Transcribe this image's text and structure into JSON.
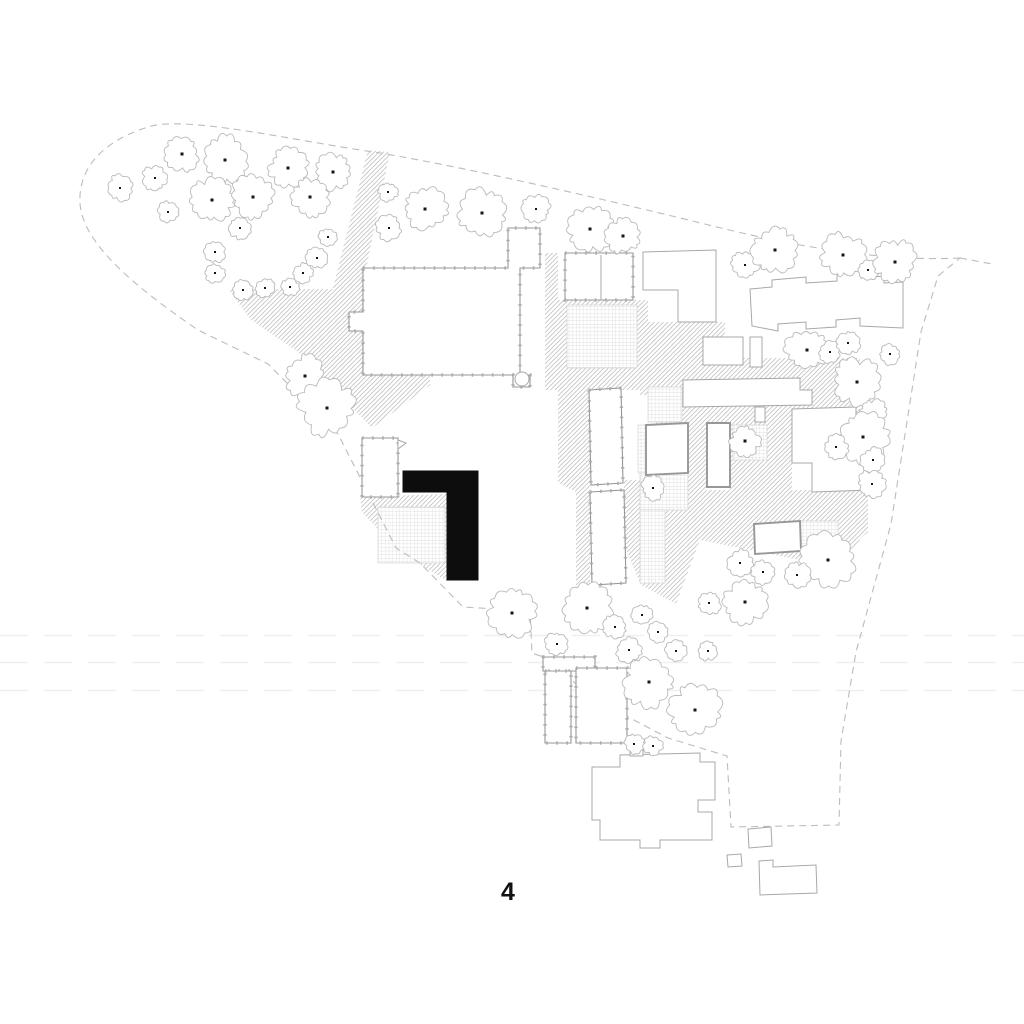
{
  "page": {
    "background": "#ffffff",
    "label": {
      "text": "4",
      "x": 508,
      "y": 878
    }
  },
  "colors": {
    "background": "#ffffff",
    "line_light": "#a8a8a8",
    "line_medium": "#979797",
    "tick_line": "#a6a6a6",
    "tree_line": "#b9b9b9",
    "tree_dot": "#151515",
    "hatch_line": "#c4c4c4",
    "grid_line": "#d3d3d3",
    "boundary_line": "#bcbcbc",
    "faint_line": "#efefef",
    "highlight": "#0d0d0d",
    "label_color": "#111111"
  },
  "plan": {
    "boundary": {
      "path": "M 960,258 C 880,262 790,245 717,227 C 620,203 470,168 380,153 C 290,140 185,115 148,127 C 103,141 78,168 80,203 C 82,243 135,287 198,330 L 268,364 L 338,434 L 396,548 L 420,563 L 463,607 L 530,611 L 532,653 L 543,657 L 596,700 L 668,738 L 727,756 L 731,827 L 839,825 L 841,741 L 856,652 L 891,524 L 921,332 L 938,276 Z",
      "tip_path": "M 960,258 L 992,264",
      "dash": "7 5"
    },
    "faint_line_ys": [
      635.5,
      662.5,
      690.5
    ],
    "hatch_areas": [
      {
        "id": "path-north",
        "points": "368,150 390,152 360,298 332,292"
      },
      {
        "id": "west-plaza",
        "points": "228,289 363,289 363,373 430,373 430,385 372,428 298,352 251,320"
      },
      {
        "id": "court-band-black-building",
        "points": "360,497 447,494 447,581 437,575 396,549 362,512"
      },
      {
        "id": "corridor",
        "points": "545,253 558,253 558,390 545,390"
      },
      {
        "id": "east-court-block",
        "points": "558,300 648,300 648,390 558,390"
      },
      {
        "id": "under-east-wing",
        "points": "640,322 725,322 725,395 640,395"
      },
      {
        "id": "north-band-right",
        "points": "655,358 860,358 860,425 655,425"
      },
      {
        "id": "west-of-bars",
        "points": "558,388 590,388 590,587 576,587 576,492 558,483"
      },
      {
        "id": "bars-gap-tail",
        "points": "624,480 700,480 700,540 676,604 641,585 624,545"
      },
      {
        "id": "mid-gap-1",
        "points": "688,420 707,420 707,500 688,500"
      },
      {
        "id": "mid-gap-2",
        "points": "730,408 792,408 792,500 730,500"
      },
      {
        "id": "south-right-field",
        "points": "700,490 868,490 868,532 840,556 800,560 700,540"
      },
      {
        "id": "east-house-patch",
        "points": "798,518 845,515 860,540 840,565 798,556"
      }
    ],
    "grid_areas": [
      {
        "id": "east-courtyard",
        "x": 567,
        "y": 305,
        "w": 70,
        "h": 63
      },
      {
        "id": "black-building-courtyard",
        "x": 378,
        "y": 507,
        "w": 67,
        "h": 56
      },
      {
        "id": "mid-court-tree",
        "x": 733,
        "y": 425,
        "w": 34,
        "h": 35
      },
      {
        "id": "southeast-court",
        "x": 800,
        "y": 521,
        "w": 38,
        "h": 35
      },
      {
        "id": "cloister-west-strip",
        "x": 638,
        "y": 425,
        "w": 10,
        "h": 48
      },
      {
        "id": "cloister-north",
        "x": 648,
        "y": 387,
        "w": 34,
        "h": 35
      },
      {
        "id": "cloister-south",
        "x": 640,
        "y": 473,
        "w": 48,
        "h": 37
      },
      {
        "id": "cloister-south-strip",
        "x": 640,
        "y": 510,
        "w": 25,
        "h": 73
      }
    ],
    "buildings": [
      {
        "id": "main-hall",
        "style": "ticked",
        "points": "363,268 508,268 508,228 540,228 540,268 520,268 520,375 530,375 530,387 513,387 513,375 363,375 363,331 349,331 349,312 363,312"
      },
      {
        "id": "east-rooms",
        "style": "ticked",
        "points": "565,253 633,253 633,300 565,300"
      },
      {
        "id": "east-wing-l",
        "style": "light",
        "points": "643,252 716,250 716,322 678,322 678,290 643,290"
      },
      {
        "id": "small-north-a",
        "style": "light",
        "points": "703,337 743,337 743,365 703,365"
      },
      {
        "id": "small-north-b",
        "style": "light",
        "points": "750,337 762,337 762,367 750,367"
      },
      {
        "id": "terraced-row-east",
        "style": "light",
        "points": "750,289 772,287 772,280 806,277 806,283 837,281 837,273 861,271 861,278 884,276 884,283 903,282 903,328 860,326 860,318 836,320 836,327 806,329 806,322 778,324 778,331 752,326"
      },
      {
        "id": "long-bar-central",
        "style": "light",
        "points": "683,380 800,378 800,390 812,390 812,405 683,407"
      },
      {
        "id": "long-bar-stub",
        "style": "light",
        "points": "755,407 765,407 765,422 755,422"
      },
      {
        "id": "cloister-house",
        "style": "medium",
        "points": "646,425 688,423 688,473 646,475"
      },
      {
        "id": "narrow-house",
        "style": "medium",
        "points": "707,423 730,423 730,487 707,487"
      },
      {
        "id": "east-l-house",
        "style": "light",
        "points": "792,409 856,407 856,427 872,427 872,490 812,492 812,463 792,463"
      },
      {
        "id": "small-east-house",
        "style": "medium",
        "points": "754,524 800,521 801,551 755,554"
      },
      {
        "id": "west-bar-upper",
        "style": "ticked",
        "points": "589,390 621,388 623,483 591,485"
      },
      {
        "id": "west-bar-lower",
        "style": "ticked",
        "points": "590,492 624,490 626,583 592,585"
      },
      {
        "id": "northwest-small-house",
        "style": "ticked",
        "points": "362,438 398,438 398,497 362,497"
      },
      {
        "id": "northwest-pennant",
        "style": "light",
        "points": "398,440 406,443 398,449"
      },
      {
        "id": "row-houses-header",
        "style": "ticked",
        "points": "543,657 595,657 595,671 543,671"
      },
      {
        "id": "row-house-left",
        "style": "ticked",
        "points": "545,671 571,671 571,743 545,743"
      },
      {
        "id": "row-house-right",
        "style": "ticked",
        "points": "576,668 627,668 627,743 576,743"
      },
      {
        "id": "south-church",
        "style": "light",
        "points": "592,767 620,767 620,755 700,753 700,762 715,762 715,800 698,800 698,812 712,812 712,840 660,840 660,848 640,848 640,840 600,840 600,820 592,820"
      },
      {
        "id": "south-church-stub",
        "style": "light",
        "points": "630,743 643,743 643,756 630,756"
      },
      {
        "id": "outbuilding-a",
        "style": "light",
        "points": "748,829 771,827 772,846 749,848"
      },
      {
        "id": "outbuilding-b",
        "style": "light",
        "points": "727,855 741,854 742,866 728,867"
      },
      {
        "id": "outbuilding-c",
        "style": "light",
        "points": "759,861 773,860 773,867 816,865 817,893 760,895"
      }
    ],
    "circles": [
      {
        "id": "apse",
        "cx": 522,
        "cy": 379,
        "r": 7
      }
    ],
    "detail_lines": [
      {
        "id": "east-rooms-divider",
        "path": "M 601,255 L 601,300"
      }
    ],
    "highlighted_building": {
      "id": "new-building-l",
      "points": "403,471 478,471 478,580 447,580 447,492 403,492"
    },
    "trees": [
      [
        120,
        188,
        12
      ],
      [
        155,
        178,
        12
      ],
      [
        182,
        154,
        16
      ],
      [
        225,
        160,
        22
      ],
      [
        212,
        200,
        20
      ],
      [
        253,
        197,
        20
      ],
      [
        288,
        168,
        18
      ],
      [
        333,
        172,
        17
      ],
      [
        310,
        197,
        18
      ],
      [
        168,
        212,
        10
      ],
      [
        240,
        228,
        10
      ],
      [
        215,
        252,
        10
      ],
      [
        215,
        273,
        9
      ],
      [
        243,
        290,
        10
      ],
      [
        265,
        288,
        9
      ],
      [
        290,
        287,
        9
      ],
      [
        303,
        273,
        9
      ],
      [
        317,
        258,
        10
      ],
      [
        328,
        237,
        9
      ],
      [
        388,
        192,
        9
      ],
      [
        389,
        228,
        12
      ],
      [
        425,
        209,
        20
      ],
      [
        482,
        213,
        22
      ],
      [
        536,
        209,
        13
      ],
      [
        590,
        229,
        22
      ],
      [
        623,
        236,
        16
      ],
      [
        745,
        265,
        13
      ],
      [
        775,
        250,
        21
      ],
      [
        843,
        255,
        21
      ],
      [
        868,
        270,
        10
      ],
      [
        895,
        262,
        20
      ],
      [
        305,
        376,
        19
      ],
      [
        327,
        408,
        26
      ],
      [
        807,
        350,
        20
      ],
      [
        830,
        352,
        10
      ],
      [
        848,
        343,
        11
      ],
      [
        890,
        354,
        10
      ],
      [
        857,
        382,
        22
      ],
      [
        874,
        413,
        13
      ],
      [
        863,
        437,
        23
      ],
      [
        836,
        447,
        11
      ],
      [
        873,
        460,
        12
      ],
      [
        872,
        484,
        13
      ],
      [
        745,
        441,
        14
      ],
      [
        653,
        488,
        11
      ],
      [
        828,
        560,
        25
      ],
      [
        797,
        575,
        12
      ],
      [
        740,
        563,
        12
      ],
      [
        763,
        572,
        11
      ],
      [
        512,
        613,
        22
      ],
      [
        557,
        644,
        11
      ],
      [
        587,
        608,
        24
      ],
      [
        615,
        627,
        11
      ],
      [
        642,
        615,
        10
      ],
      [
        658,
        632,
        10
      ],
      [
        629,
        650,
        12
      ],
      [
        676,
        651,
        10
      ],
      [
        708,
        651,
        9
      ],
      [
        709,
        603,
        11
      ],
      [
        745,
        602,
        20
      ],
      [
        649,
        682,
        24
      ],
      [
        695,
        710,
        24
      ],
      [
        634,
        744,
        9
      ],
      [
        653,
        746,
        9
      ]
    ]
  }
}
